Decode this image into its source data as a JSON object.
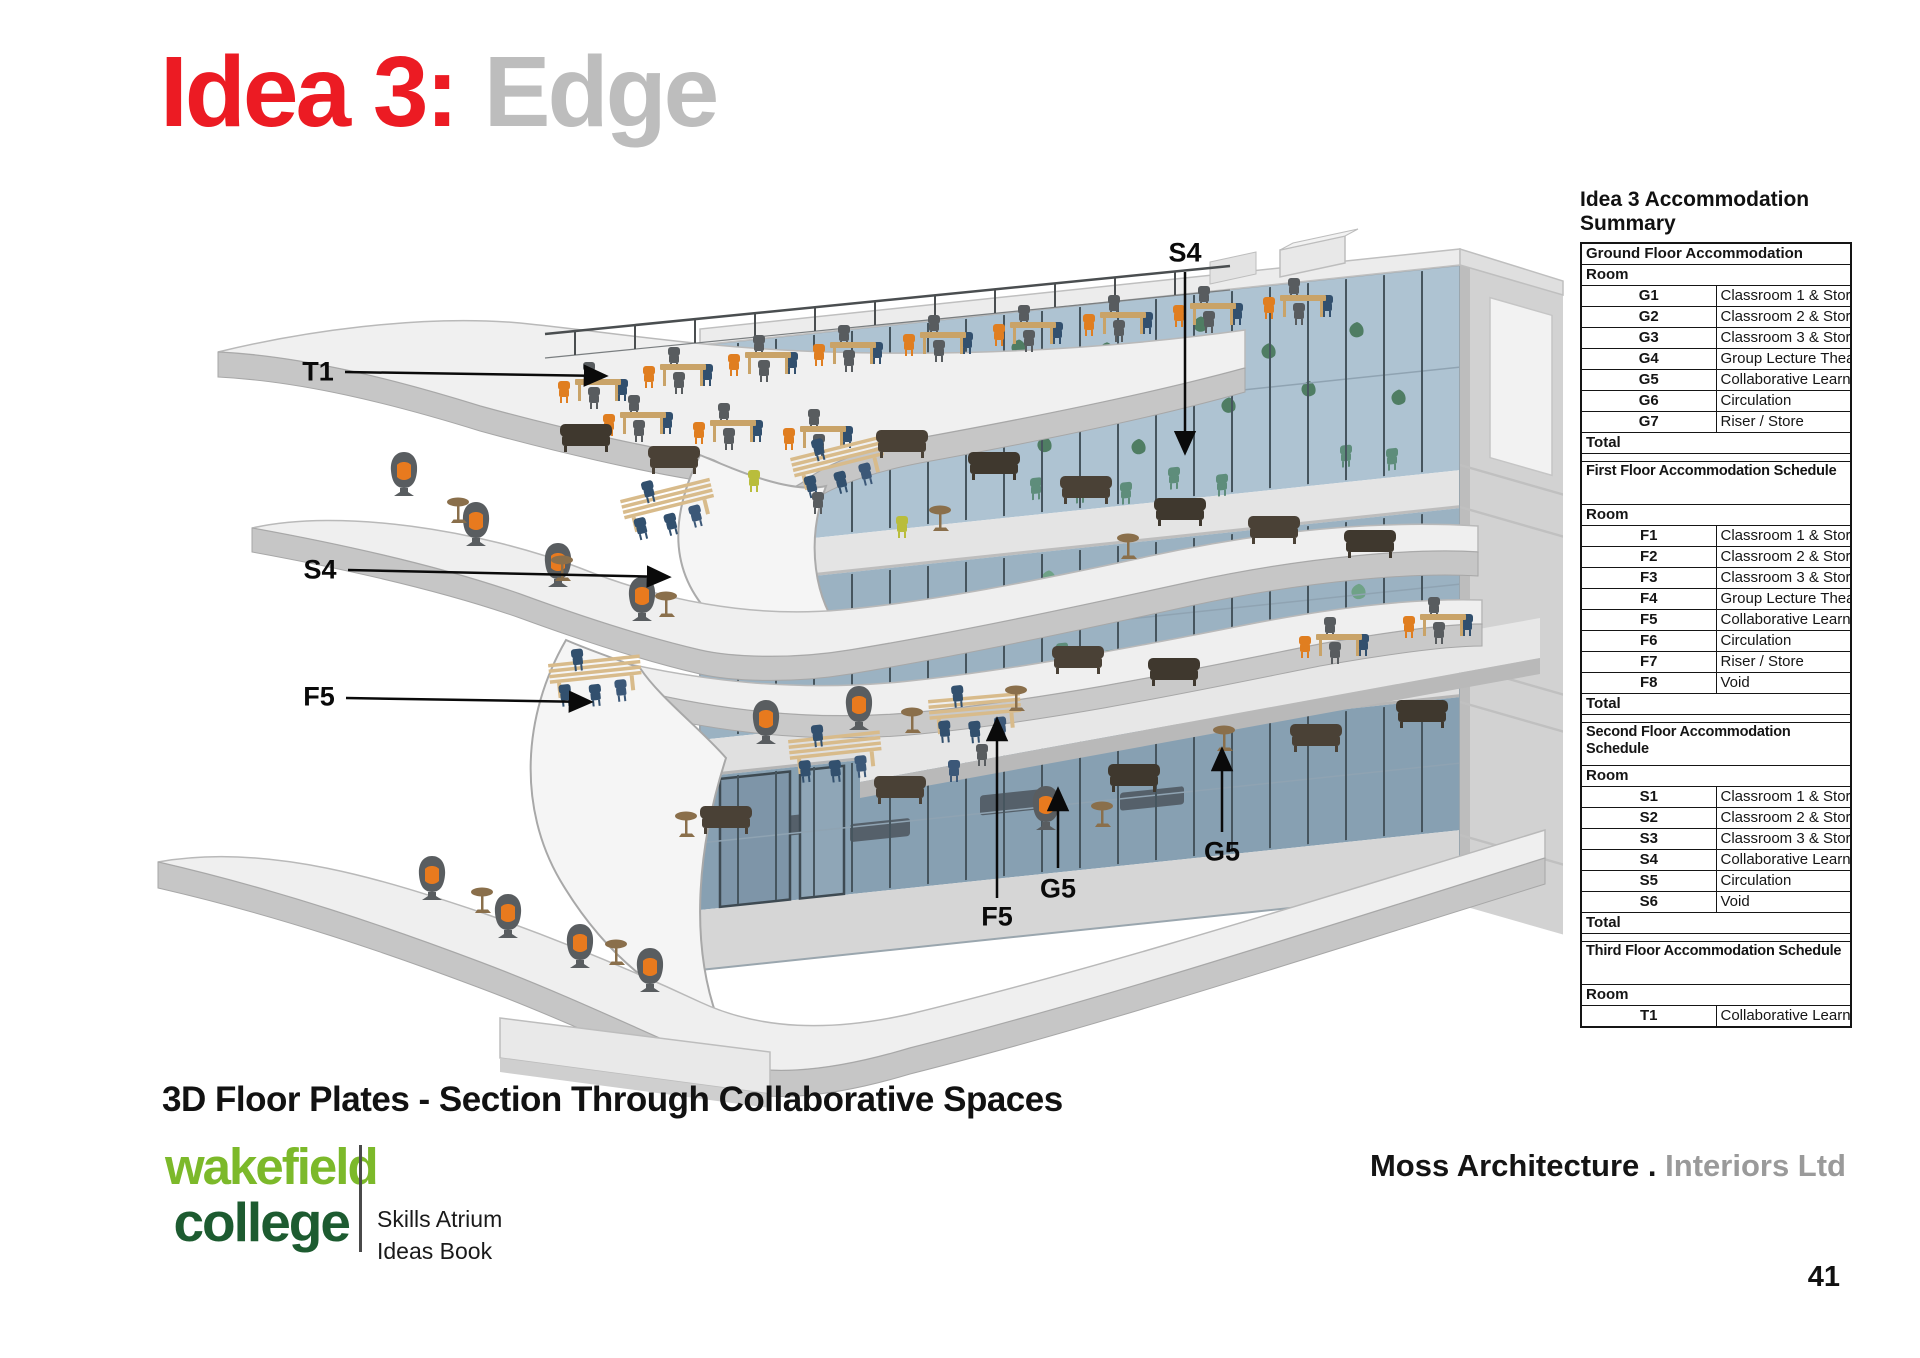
{
  "title": {
    "prefix": "Idea 3:",
    "suffix": "Edge"
  },
  "caption": "3D Floor Plates - Section Through Collaborative Spaces",
  "logo": {
    "line1": "wakefield",
    "line2": "college",
    "tagline1": "Skills Atrium",
    "tagline2": "Ideas Book"
  },
  "footer": {
    "brand_primary": "Moss Architecture .",
    "brand_secondary": "Interiors Ltd",
    "page_number": "41"
  },
  "annotations": [
    {
      "text": "T1",
      "x": 318,
      "y": 372
    },
    {
      "text": "S4",
      "x": 1185,
      "y": 253
    },
    {
      "text": "S4",
      "x": 320,
      "y": 570
    },
    {
      "text": "F5",
      "x": 319,
      "y": 697
    },
    {
      "text": "F5",
      "x": 997,
      "y": 917
    },
    {
      "text": "G5",
      "x": 1058,
      "y": 889
    },
    {
      "text": "G5",
      "x": 1222,
      "y": 852
    }
  ],
  "summary_table": {
    "title": "Idea 3 Accommodation Summary",
    "sections": [
      {
        "header": "Ground Floor Accommodation",
        "tall_header": false,
        "room_label": "Room",
        "rows": [
          [
            "G1",
            "Classroom 1 & Store"
          ],
          [
            "G2",
            "Classroom 2 & Store"
          ],
          [
            "G3",
            "Classroom 3 & Store"
          ],
          [
            "G4",
            "Group Lecture Theatre"
          ],
          [
            "G5",
            "Collaborative Learning"
          ],
          [
            "G6",
            "Circulation"
          ],
          [
            "G7",
            "Riser / Store"
          ]
        ],
        "total_label": "Total",
        "spacer_after": true
      },
      {
        "header": "First Floor Accommodation Schedule",
        "tall_header": true,
        "room_label": "Room",
        "rows": [
          [
            "F1",
            "Classroom 1 & Store"
          ],
          [
            "F2",
            "Classroom 2 & Store"
          ],
          [
            "F3",
            "Classroom 3 & Store"
          ],
          [
            "F4",
            "Group Lecture Theatre"
          ],
          [
            "F5",
            "Collaborative Learning"
          ],
          [
            "F6",
            "Circulation"
          ],
          [
            "F7",
            "Riser / Store"
          ],
          [
            "F8",
            "Void"
          ]
        ],
        "total_label": "Total",
        "spacer_after": true
      },
      {
        "header": "Second Floor Accommodation Schedule",
        "tall_header": true,
        "room_label": "Room",
        "rows": [
          [
            "S1",
            "Classroom 1 & Store"
          ],
          [
            "S2",
            "Classroom 2 & Store"
          ],
          [
            "S3",
            "Classroom 3 & Store"
          ],
          [
            "S4",
            "Collaborative Learning"
          ],
          [
            "S5",
            "Circulation"
          ],
          [
            "S6",
            "Void"
          ]
        ],
        "total_label": "Total",
        "spacer_after": true
      },
      {
        "header": "Third Floor Accommodation Schedule",
        "tall_header": true,
        "room_label": "Room",
        "rows": [
          [
            "T1",
            "Collaborative Learning"
          ]
        ],
        "total_label": null,
        "spacer_after": false
      }
    ]
  },
  "colors": {
    "title_red": "#EC1B23",
    "title_gray": "#BDBDBD",
    "logo_green_light": "#7CB92A",
    "logo_green_dark": "#1D5B30",
    "brand_gray": "#9A9A9A",
    "accent_orange": "#E87A1E",
    "glass_blue": "#AEC3D2"
  }
}
